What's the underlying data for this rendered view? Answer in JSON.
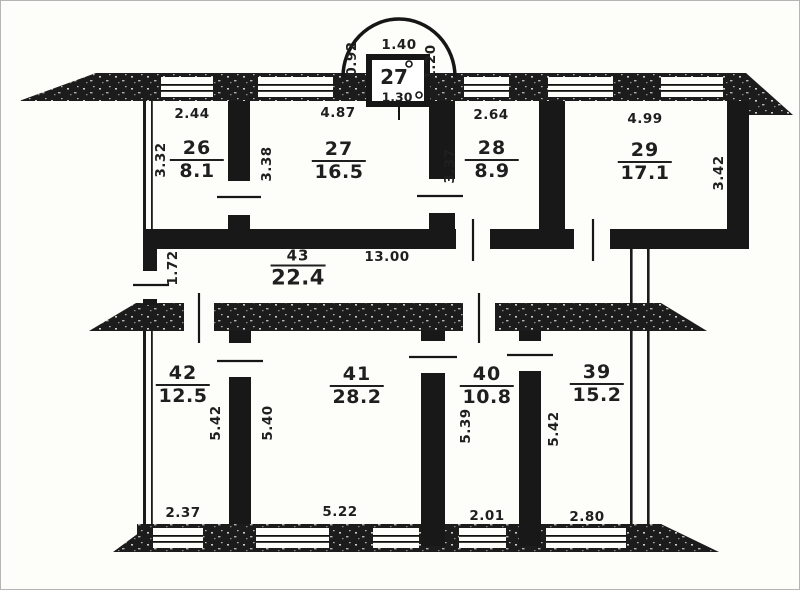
{
  "drawing": {
    "kind": "apartment-floor-plan"
  },
  "rooms": {
    "r26": {
      "number": "26",
      "area": "8.1",
      "dim_top": "2.44",
      "dim_side": "3.32"
    },
    "r27": {
      "number": "27",
      "area": "16.5",
      "dim_top": "4.87",
      "dim_side": "3.38"
    },
    "r28": {
      "number": "28",
      "area": "8.9",
      "dim_top": "2.64",
      "dim_side": "3.37"
    },
    "r29": {
      "number": "29",
      "area": "17.1",
      "dim_top": "4.99",
      "dim_side": "3.42"
    },
    "r43": {
      "number": "43",
      "area": "22.4",
      "dim_length": "13.00",
      "dim_width": "1.72"
    },
    "r42": {
      "number": "42",
      "area": "12.5",
      "dim_side": "5.42",
      "dim_bottom": "2.37"
    },
    "r41": {
      "number": "41",
      "area": "28.2",
      "dim_side": "5.40",
      "dim_bottom": "5.22"
    },
    "r40": {
      "number": "40",
      "area": "10.8",
      "dim_side": "5.39",
      "dim_bottom": "2.01"
    },
    "r39": {
      "number": "39",
      "area": "15.2",
      "dim_side": "5.42",
      "dim_bottom": "2.80"
    }
  },
  "balcony": {
    "number": "27",
    "dim_top": "1.40",
    "dim_left": "0.92",
    "dim_right": "1.20",
    "dim_bottom": "1.30"
  },
  "colors": {
    "wall": "#1b1b1b",
    "paper": "#fdfdfa",
    "text": "#1f1f1f"
  }
}
